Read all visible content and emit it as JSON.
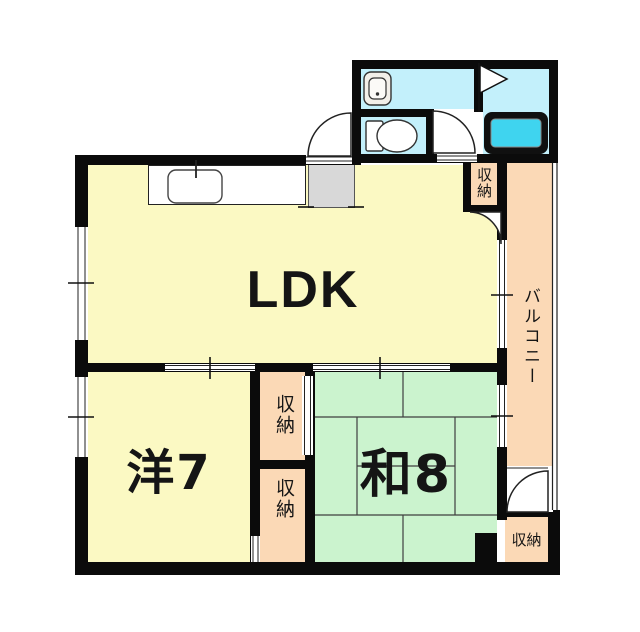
{
  "plan": {
    "type": "japanese-apartment-floor-plan",
    "rooms": {
      "ldk": {
        "label": "LDK"
      },
      "western_room": {
        "label": "洋7"
      },
      "japanese_room": {
        "label": "和8"
      },
      "balcony": {
        "label": "バルコニー"
      }
    },
    "storages": {
      "ldk_storage": {
        "label": "収納"
      },
      "upper_storage": {
        "label": "収納"
      },
      "lower_storage": {
        "label": "収納"
      },
      "balcony_storage": {
        "label": "収納"
      }
    },
    "fixtures": [
      "kitchen-sink",
      "entry-mat",
      "washbasin",
      "toilet",
      "bathtub",
      "door-swing"
    ],
    "colors": {
      "wall": "#0b0b0b",
      "room_yellow": "#FBF9C3",
      "tatami_green": "#CBF3CE",
      "balcony_salmon": "#FBD9B6",
      "bath_cyan": "#C3F0FB",
      "bathtub_cyan": "#3FD4EF",
      "entry_gray": "#D8D8D8"
    }
  }
}
